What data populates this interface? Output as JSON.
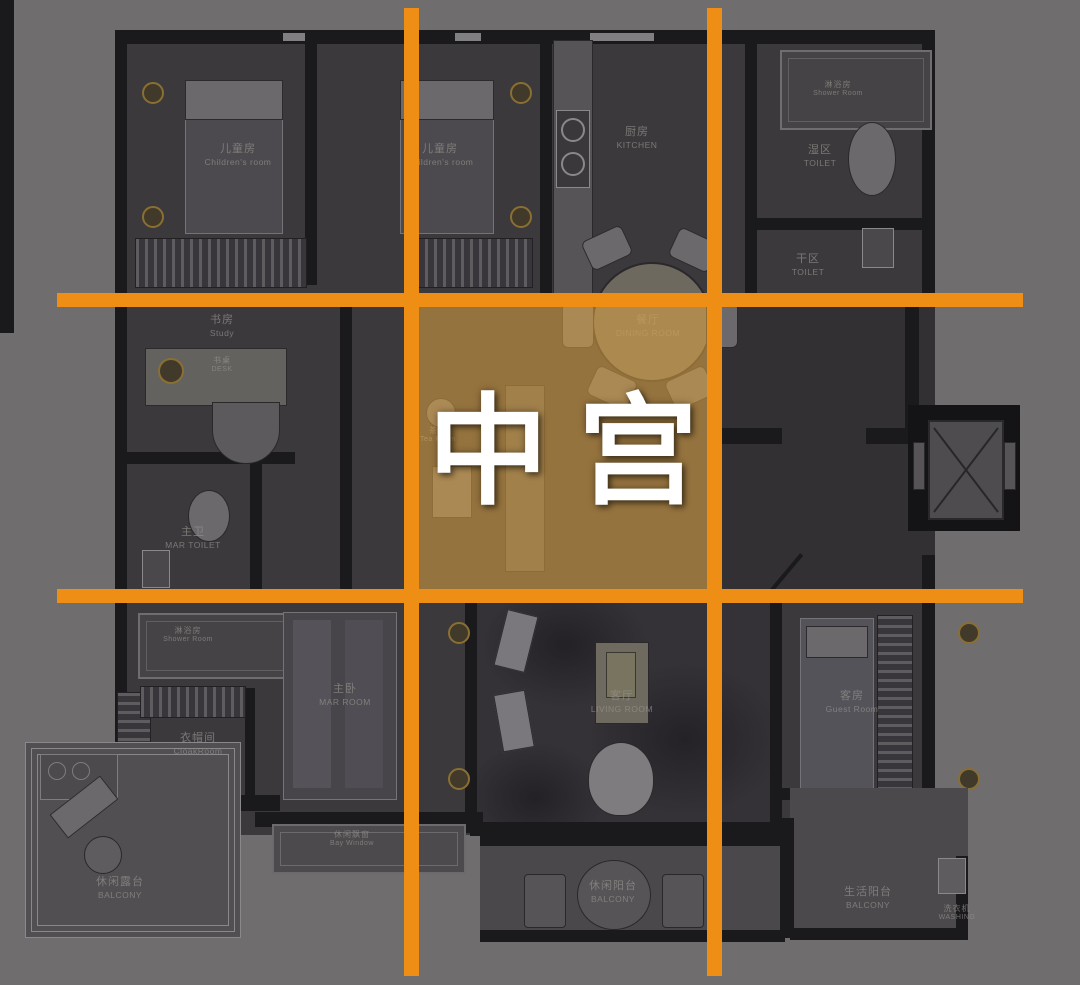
{
  "overlay": {
    "center_label": "中宫",
    "grid_color": "#EF8E15",
    "highlight_color": "rgba(224,164,66,0.55)"
  },
  "rooms": [
    {
      "zh": "儿童房",
      "en": "Children's room",
      "x": 238,
      "y": 143,
      "size": "m"
    },
    {
      "zh": "儿童房",
      "en": "Children's room",
      "x": 440,
      "y": 143,
      "size": "m"
    },
    {
      "zh": "厨房",
      "en": "KITCHEN",
      "x": 637,
      "y": 126,
      "size": "m"
    },
    {
      "zh": "淋浴房",
      "en": "Shower Room",
      "x": 838,
      "y": 80,
      "size": "s"
    },
    {
      "zh": "湿区",
      "en": "TOILET",
      "x": 820,
      "y": 144,
      "size": "m"
    },
    {
      "zh": "干区",
      "en": "TOILET",
      "x": 808,
      "y": 253,
      "size": "m"
    },
    {
      "zh": "书房",
      "en": "Study",
      "x": 222,
      "y": 314,
      "size": "m"
    },
    {
      "zh": "书桌",
      "en": "DESK",
      "x": 222,
      "y": 356,
      "size": "s"
    },
    {
      "zh": "餐厅",
      "en": "DINING ROOM",
      "x": 648,
      "y": 314,
      "size": "m"
    },
    {
      "zh": "茶室",
      "en": "Tea Room",
      "x": 438,
      "y": 426,
      "size": "s"
    },
    {
      "zh": "主卫",
      "en": "MAR TOILET",
      "x": 193,
      "y": 526,
      "size": "m"
    },
    {
      "zh": "淋浴房",
      "en": "Shower Room",
      "x": 188,
      "y": 626,
      "size": "s"
    },
    {
      "zh": "衣帽间",
      "en": "CloakRoom",
      "x": 198,
      "y": 732,
      "size": "m"
    },
    {
      "zh": "主卧",
      "en": "MAR ROOM",
      "x": 345,
      "y": 683,
      "size": "m"
    },
    {
      "zh": "客厅",
      "en": "LIVING ROOM",
      "x": 622,
      "y": 690,
      "size": "m"
    },
    {
      "zh": "客房",
      "en": "Guest Room",
      "x": 852,
      "y": 690,
      "size": "m"
    },
    {
      "zh": "休闲飘窗",
      "en": "Bay Window",
      "x": 352,
      "y": 830,
      "size": "s"
    },
    {
      "zh": "休闲露台",
      "en": "BALCONY",
      "x": 120,
      "y": 876,
      "size": "m"
    },
    {
      "zh": "休闲阳台",
      "en": "BALCONY",
      "x": 613,
      "y": 880,
      "size": "m"
    },
    {
      "zh": "生活阳台",
      "en": "BALCONY",
      "x": 868,
      "y": 886,
      "size": "m"
    },
    {
      "zh": "洗衣机",
      "en": "WASHING",
      "x": 957,
      "y": 904,
      "size": "s"
    }
  ]
}
